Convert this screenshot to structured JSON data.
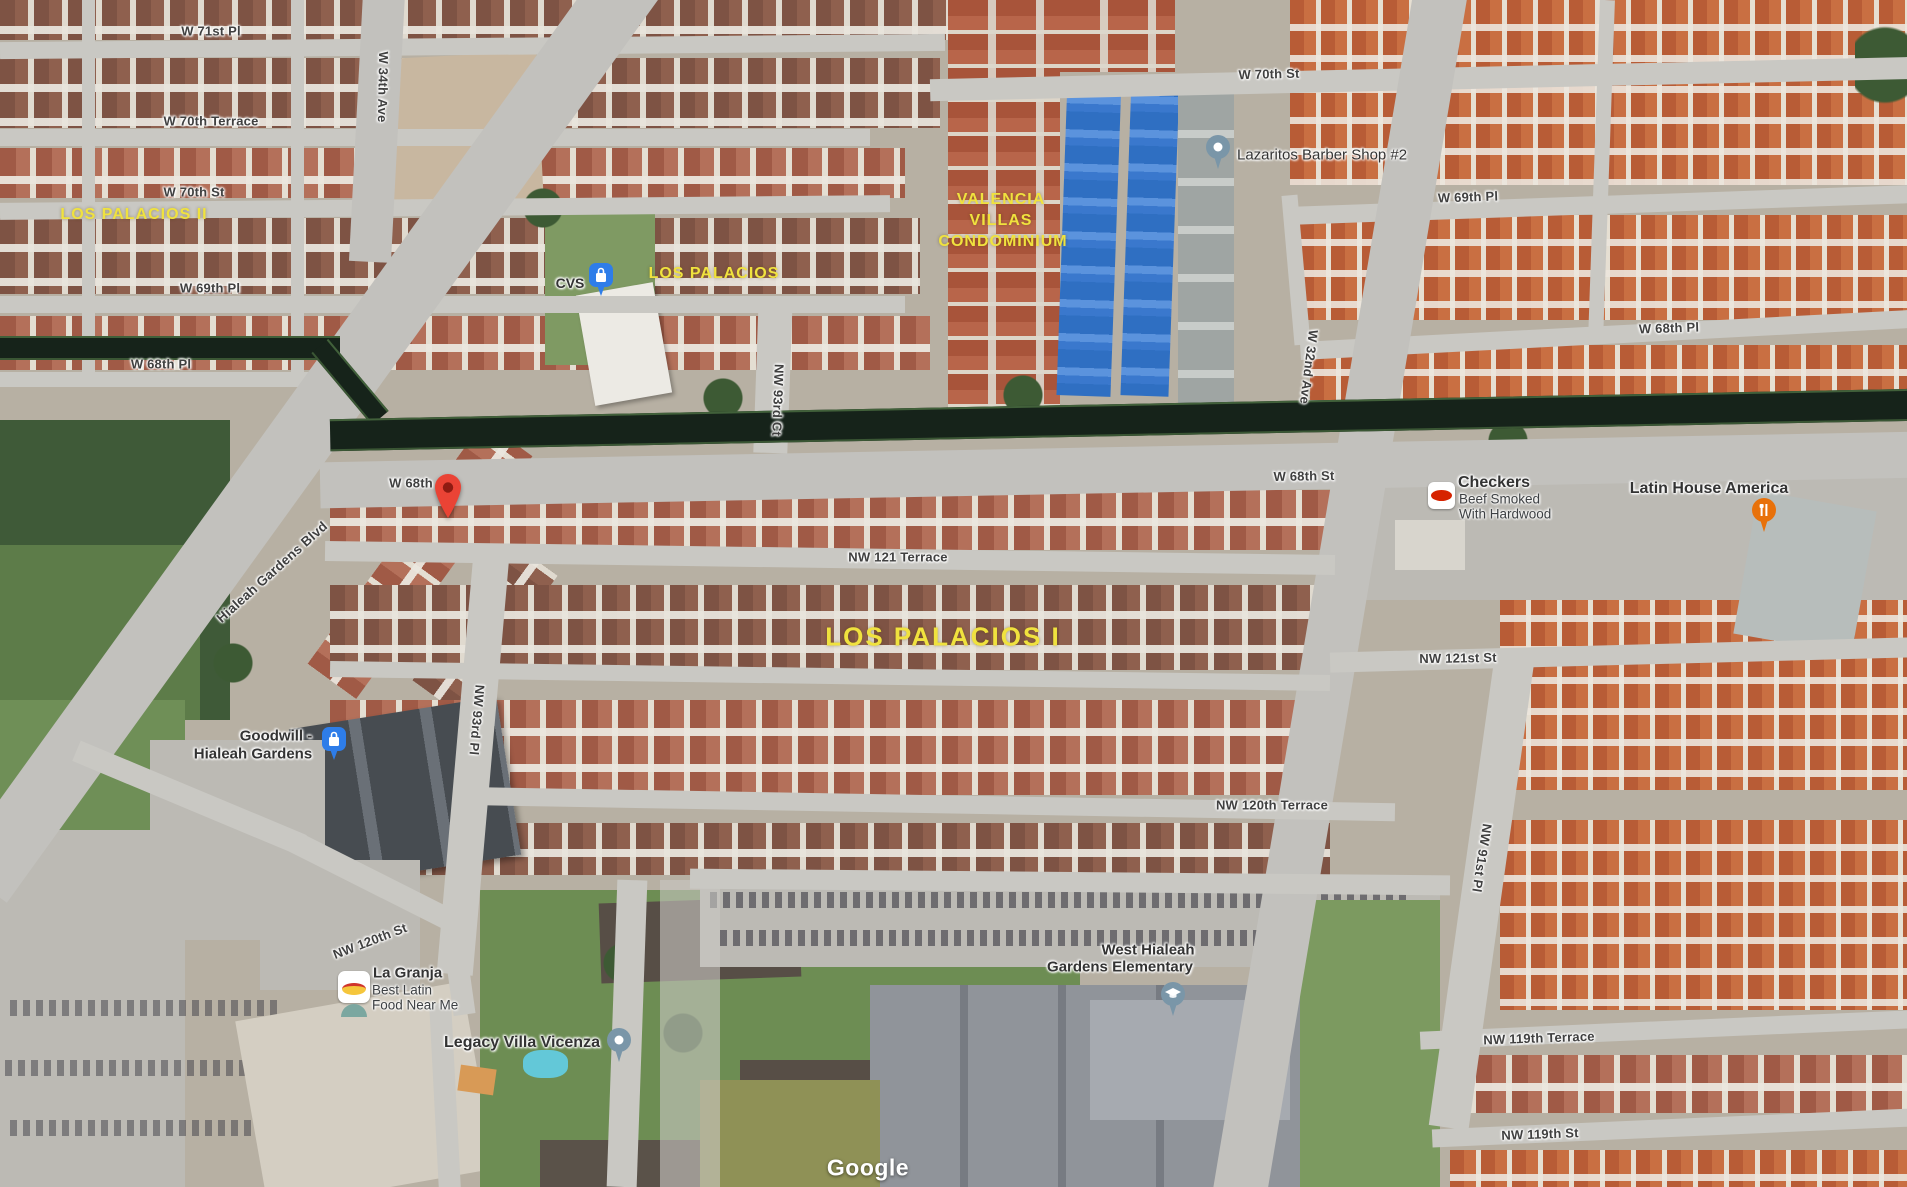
{
  "attribution": {
    "text": "Google"
  },
  "colors": {
    "marker_red": "#EA4335",
    "marker_red_dark": "#8F1B12",
    "poi_blue": "#2E7DE9",
    "poi_slate": "#7A96A8",
    "poi_orange": "#E8710A",
    "area_label_yellow": "#F0E23E",
    "checkers_red": "#D62300",
    "la_granja_yellow": "#F5C63C"
  },
  "street_labels": [
    {
      "text": "W 71st Pl"
    },
    {
      "text": "W 70th Terrace"
    },
    {
      "text": "W 70th St"
    },
    {
      "text": "W 69th Pl"
    },
    {
      "text": "W 68th Pl"
    },
    {
      "text": "W 34th Ave"
    },
    {
      "text": "W 70th St"
    },
    {
      "text": "W 69th Pl"
    },
    {
      "text": "W 68th Pl"
    },
    {
      "text": "W 32nd Ave"
    },
    {
      "text": "W 68th"
    },
    {
      "text": "W 68th St"
    },
    {
      "text": "NW 121 Terrace"
    },
    {
      "text": "NW 121st St"
    },
    {
      "text": "NW 120th Terrace"
    },
    {
      "text": "NW 120th St"
    },
    {
      "text": "NW 119th Terrace"
    },
    {
      "text": "NW 119th St"
    },
    {
      "text": "NW 93rd Ct"
    },
    {
      "text": "NW 93rd Pl"
    },
    {
      "text": "NW 91st Pl"
    },
    {
      "text": "Hialeah Gardens Blvd"
    }
  ],
  "area_labels": [
    {
      "text": "LOS PALACIOS II"
    },
    {
      "text": "LOS PALACIOS"
    },
    {
      "text": "VALENCIA"
    },
    {
      "text": "VILLAS"
    },
    {
      "text": "CONDOMINIUM"
    },
    {
      "text": "LOS PALACIOS I"
    }
  ],
  "pois": {
    "cvs": {
      "name": "CVS"
    },
    "lazaritos": {
      "name": "Lazaritos Barber Shop #2"
    },
    "checkers": {
      "name": "Checkers",
      "line2": "Beef Smoked",
      "line3": "With Hardwood"
    },
    "latin_house": {
      "name": "Latin House America"
    },
    "goodwill": {
      "name_line1": "Goodwill -",
      "name_line2": "Hialeah Gardens"
    },
    "la_granja": {
      "name": "La Granja",
      "line2": "Best Latin",
      "line3": "Food Near Me"
    },
    "legacy": {
      "name": "Legacy Villa Vicenza"
    },
    "school": {
      "name_line1": "West Hialeah",
      "name_line2": "Gardens Elementary"
    }
  }
}
